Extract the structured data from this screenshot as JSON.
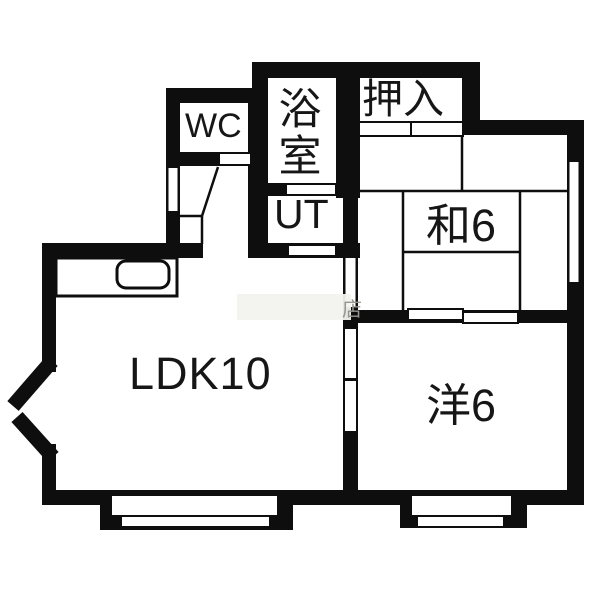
{
  "plan": {
    "title": "apartment-floor-plan",
    "rooms": [
      {
        "id": "wc",
        "label": "WC"
      },
      {
        "id": "bathroom",
        "label": "浴室"
      },
      {
        "id": "closet",
        "label": "押入"
      },
      {
        "id": "utility",
        "label": "UT"
      },
      {
        "id": "japanese-room",
        "label": "和6"
      },
      {
        "id": "ldk",
        "label": "LDK10"
      },
      {
        "id": "western-room",
        "label": "洋6"
      }
    ],
    "watermark": {
      "visible_text": "店"
    },
    "colors": {
      "wall": "#0e0e0e",
      "background": "#ffffff",
      "watermark_text": "#96968f",
      "watermark_band": "#f2f2ef"
    }
  }
}
